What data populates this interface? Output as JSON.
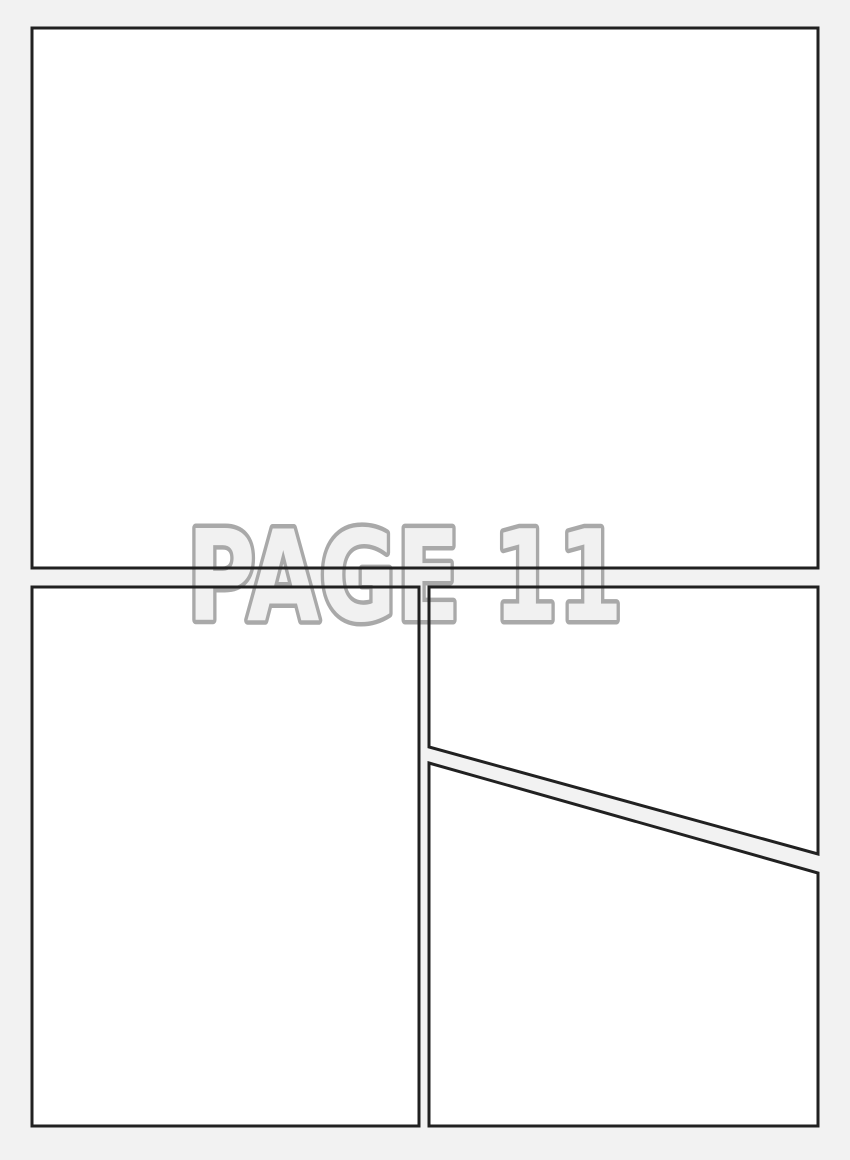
{
  "watermark": {
    "text": "PAGE 11"
  },
  "colors": {
    "page_background": "#f2f2f2",
    "panel_fill": "#ffffff",
    "panel_border": "#212121",
    "watermark_fill": "#f1f1f1",
    "watermark_outline": "#a9a9a9"
  }
}
